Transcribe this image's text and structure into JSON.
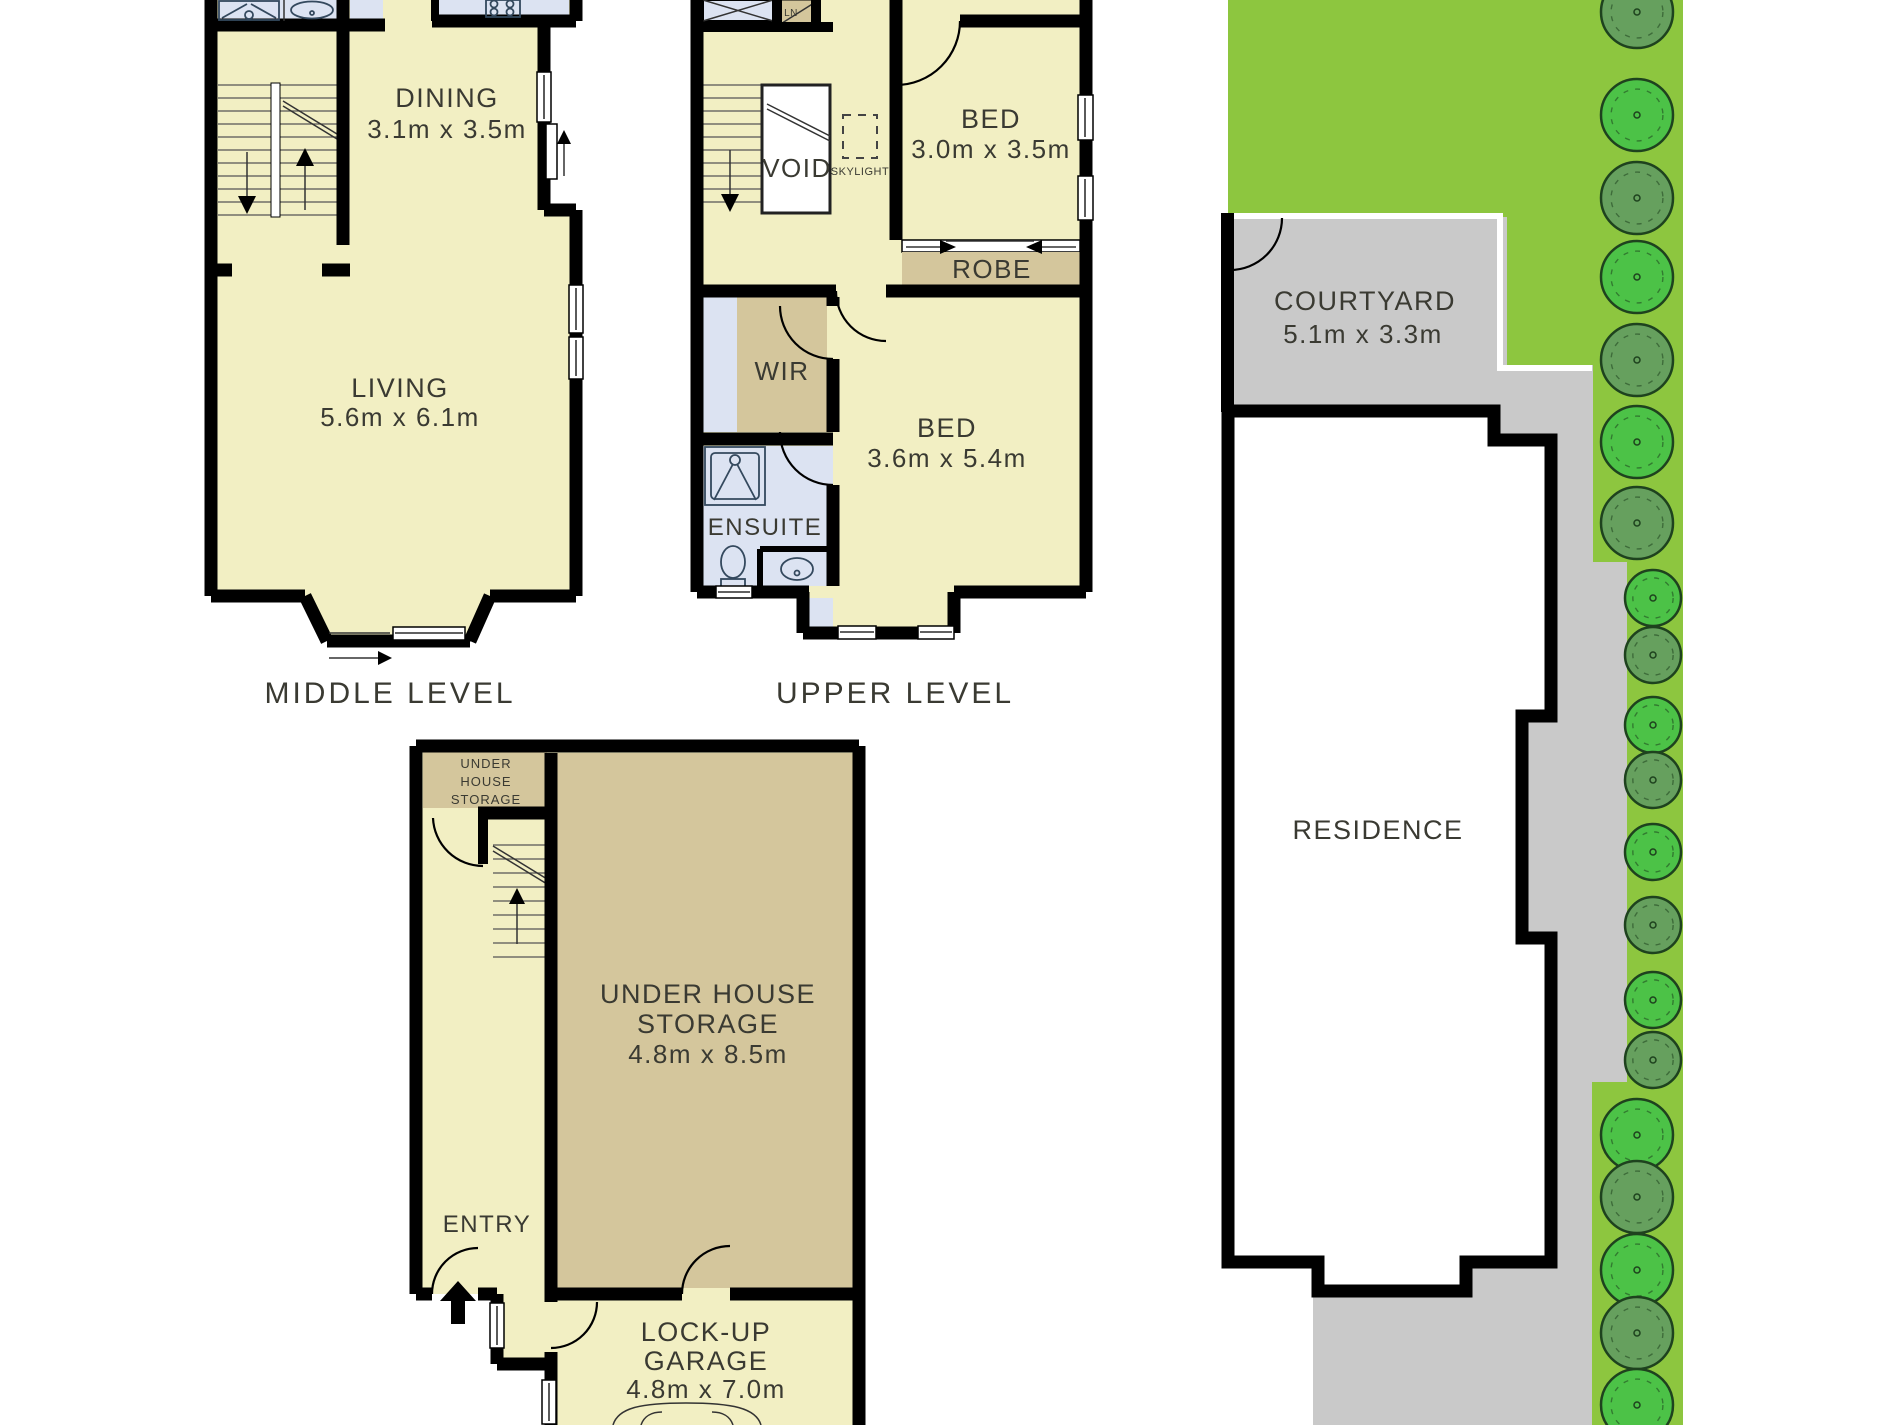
{
  "colors": {
    "wall": "#000000",
    "cream": "#f2efc3",
    "tan": "#d4c69c",
    "blue": "#dce3f2",
    "lawn": "#8dc63f",
    "treeDark": "#66a05e",
    "treeLight": "#4cc247",
    "treeOutline": "#1e421e",
    "path": "#c9c9c9",
    "text": "#3a3a32"
  },
  "plans": {
    "middle": {
      "level_label": "MIDDLE LEVEL",
      "dining_name": "DINING",
      "dining_dims": "3.1m x 3.5m",
      "living_name": "LIVING",
      "living_dims": "5.6m x 6.1m"
    },
    "upper": {
      "level_label": "UPPER LEVEL",
      "bed1_name": "BED",
      "bed1_dims": "3.0m x 3.5m",
      "bed2_name": "BED",
      "bed2_dims": "3.6m x 5.4m",
      "robe": "ROBE",
      "wir": "WIR",
      "ensuite": "ENSUITE",
      "void": "VOID",
      "skylight": "SKYLIGHT",
      "linen": "LN"
    },
    "ground": {
      "storage_small_l1": "UNDER",
      "storage_small_l2": "HOUSE",
      "storage_small_l3": "STORAGE",
      "storage_l1": "UNDER HOUSE",
      "storage_l2": "STORAGE",
      "storage_dims": "4.8m x 8.5m",
      "entry": "ENTRY",
      "garage_l1": "LOCK-UP",
      "garage_l2": "GARAGE",
      "garage_dims": "4.8m x 7.0m"
    }
  },
  "site": {
    "courtyard_name": "COURTYARD",
    "courtyard_dims": "5.1m x 3.3m",
    "residence": "RESIDENCE",
    "trees": [
      {
        "y": 12,
        "tone": "dark",
        "size": "wide"
      },
      {
        "y": 115,
        "tone": "light",
        "size": "wide"
      },
      {
        "y": 198,
        "tone": "dark",
        "size": "wide"
      },
      {
        "y": 277,
        "tone": "light",
        "size": "wide"
      },
      {
        "y": 360,
        "tone": "dark",
        "size": "wide"
      },
      {
        "y": 442,
        "tone": "light",
        "size": "wide"
      },
      {
        "y": 523,
        "tone": "dark",
        "size": "wide"
      },
      {
        "y": 598,
        "tone": "light",
        "size": "narrow"
      },
      {
        "y": 655,
        "tone": "dark",
        "size": "narrow"
      },
      {
        "y": 725,
        "tone": "light",
        "size": "narrow"
      },
      {
        "y": 780,
        "tone": "dark",
        "size": "narrow"
      },
      {
        "y": 852,
        "tone": "light",
        "size": "narrow"
      },
      {
        "y": 925,
        "tone": "dark",
        "size": "narrow"
      },
      {
        "y": 1000,
        "tone": "light",
        "size": "narrow"
      },
      {
        "y": 1060,
        "tone": "dark",
        "size": "narrow"
      },
      {
        "y": 1135,
        "tone": "light",
        "size": "wide"
      },
      {
        "y": 1197,
        "tone": "dark",
        "size": "wide"
      },
      {
        "y": 1270,
        "tone": "light",
        "size": "wide"
      },
      {
        "y": 1333,
        "tone": "dark",
        "size": "wide"
      },
      {
        "y": 1405,
        "tone": "light",
        "size": "wide"
      }
    ]
  }
}
